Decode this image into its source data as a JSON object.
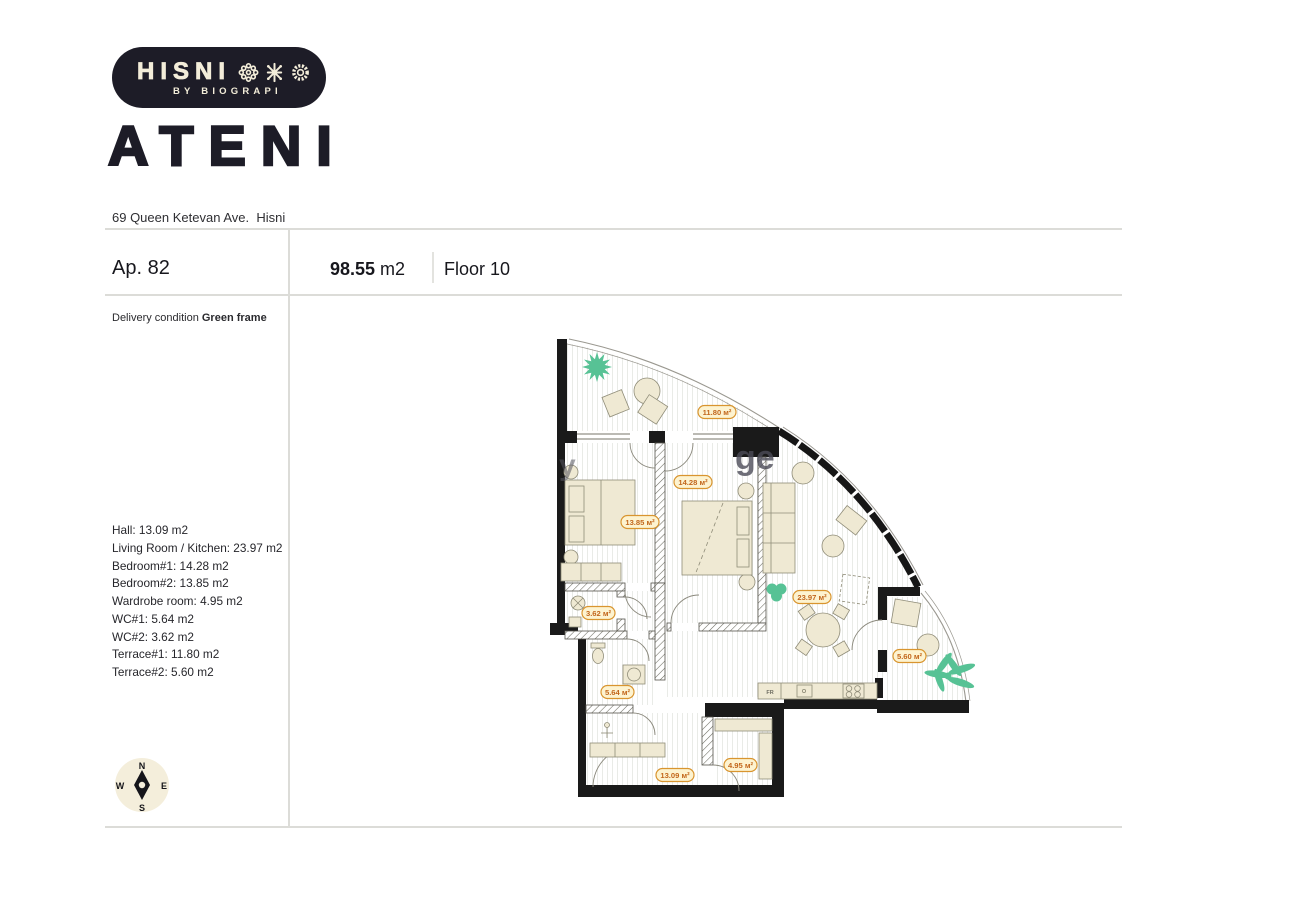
{
  "brand": {
    "name": "HISNI",
    "tagline": "BY BIOGRAPI",
    "building": "ATENI",
    "address": "69 Queen Ketevan Ave.  Hisni"
  },
  "apartment": {
    "number_label": "Ap. 82",
    "area_value": "98.55",
    "area_unit": " m2",
    "floor_label": "Floor 10",
    "delivery_label": "Delivery condition ",
    "delivery_value": "Green frame"
  },
  "room_list": [
    "Hall: 13.09 m2",
    "Living Room / Kitchen: 23.97 m2",
    "Bedroom#1: 14.28 m2",
    "Bedroom#2: 13.85 m2",
    "Wardrobe room: 4.95 m2",
    "WC#1: 5.64 m2",
    "WC#2: 3.62 m2",
    "Terrace#1: 11.80 m2",
    "Terrace#2: 5.60 m2"
  ],
  "plan": {
    "area_labels": {
      "terrace1": "11.80 м²",
      "bedroom1": "14.28 м²",
      "bedroom2": "13.85 м²",
      "living": "23.97 м²",
      "wc2": "3.62 м²",
      "wc1": "5.64 м²",
      "hall": "13.09 м²",
      "wardrobe": "4.95 м²",
      "terrace2": "5.60 м²"
    },
    "fridge_label": "FR",
    "watermark_fragment_1": "y",
    "watermark_fragment_2": "ge"
  },
  "compass": {
    "north": "N",
    "south": "S",
    "east": "E",
    "west": "W"
  },
  "colors": {
    "brand_dark": "#1d1c27",
    "cream": "#f3edd9",
    "wall_black": "#1a1a1a",
    "furniture_fill": "#efe9d3",
    "label_fill": "#fdf3d0",
    "label_border": "#d9952f",
    "label_text": "#c2661b",
    "plant_green": "#57c295",
    "rule_gray": "#dcdcd8"
  }
}
